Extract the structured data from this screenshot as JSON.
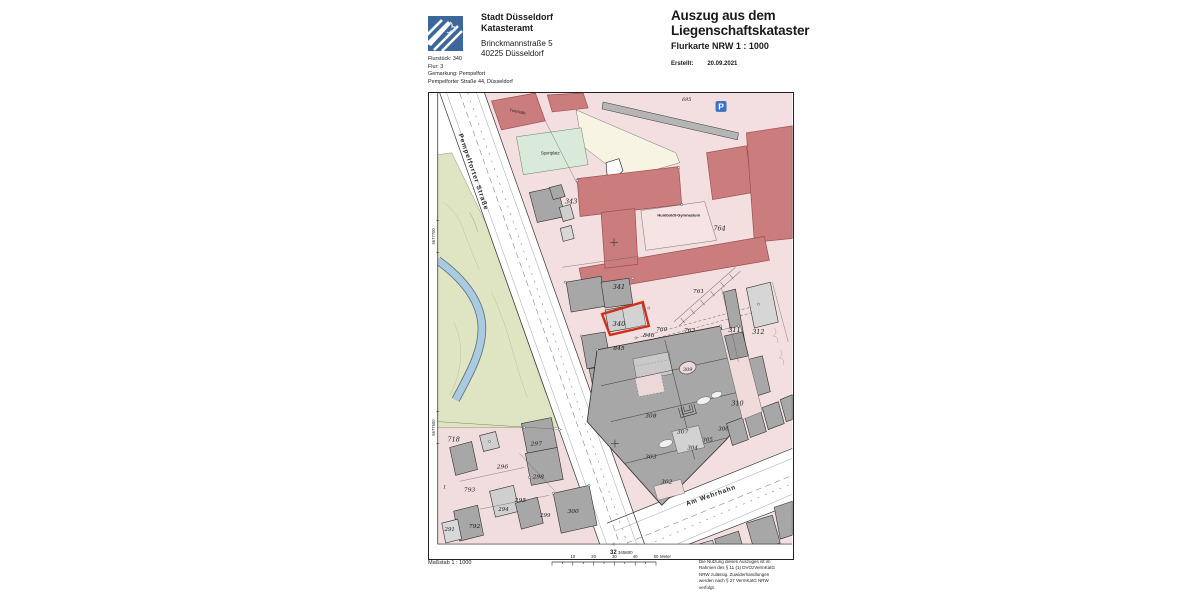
{
  "header": {
    "org_line1": "Stadt Düsseldorf",
    "org_line2": "Katasteramt",
    "address_line1": "Brinckmannstraße 5",
    "address_line2": "40225 Düsseldorf",
    "meta_lines": [
      "Flurstück: 340",
      "Flur: 3",
      "Gemarkung: Pempelfort",
      "Pempelforter Straße 44, Düsseldorf"
    ],
    "title_line1": "Auszug aus dem",
    "title_line2": "Liegenschaftskataster",
    "subtitle": "Flurkarte NRW 1 : 1000",
    "created_label": "Erstellt:",
    "created_date": "20.09.2021"
  },
  "map": {
    "highlight_parcel": "340",
    "parking_icon": "P",
    "colors": {
      "block_pink": "#f3dfdf",
      "building_gray": "#a7a7a7",
      "building_light": "#cfcfcf",
      "public_red": "#cb7d7d",
      "sport_green": "#d9e9da",
      "courtyard_cream": "#f8f4e4",
      "park_green": "#dfe5c2",
      "water_blue": "#a9cae1",
      "highlight_red": "#d22f1b"
    },
    "labels": [
      {
        "t": "695",
        "x": 258,
        "y": 8,
        "s": 5,
        "k": "num"
      },
      {
        "t": "343",
        "x": 142,
        "y": 111,
        "s": 6.5,
        "k": "num"
      },
      {
        "t": "341",
        "x": 190,
        "y": 197,
        "s": 6.5,
        "k": "num"
      },
      {
        "t": "340",
        "x": 190,
        "y": 234,
        "s": 6.8,
        "k": "num"
      },
      {
        "t": "764",
        "x": 291,
        "y": 138,
        "s": 6.5,
        "k": "num"
      },
      {
        "t": "761",
        "x": 270,
        "y": 201,
        "s": 6,
        "k": "num"
      },
      {
        "t": "760",
        "x": 233,
        "y": 239,
        "s": 6,
        "k": "num"
      },
      {
        "t": "846",
        "x": 220,
        "y": 245,
        "s": 6,
        "k": "num"
      },
      {
        "t": "763",
        "x": 261,
        "y": 240,
        "s": 6,
        "k": "num"
      },
      {
        "t": "845",
        "x": 190,
        "y": 258,
        "s": 6,
        "k": "num"
      },
      {
        "t": "311",
        "x": 306,
        "y": 240,
        "s": 6.5,
        "k": "num"
      },
      {
        "t": "312",
        "x": 330,
        "y": 242,
        "s": 6.5,
        "k": "num"
      },
      {
        "t": "309",
        "x": 259,
        "y": 279,
        "s": 5,
        "k": "num"
      },
      {
        "t": "310",
        "x": 309,
        "y": 314,
        "s": 6.5,
        "k": "num"
      },
      {
        "t": "308",
        "x": 222,
        "y": 326,
        "s": 6,
        "k": "num"
      },
      {
        "t": "307",
        "x": 254,
        "y": 342,
        "s": 6,
        "k": "num"
      },
      {
        "t": "306",
        "x": 295,
        "y": 339,
        "s": 5.5,
        "k": "num"
      },
      {
        "t": "305",
        "x": 279,
        "y": 350,
        "s": 5.5,
        "k": "num"
      },
      {
        "t": "304",
        "x": 264,
        "y": 358,
        "s": 5.5,
        "k": "num"
      },
      {
        "t": "303",
        "x": 222,
        "y": 367,
        "s": 6,
        "k": "num"
      },
      {
        "t": "302",
        "x": 238,
        "y": 392,
        "s": 6,
        "k": "num"
      },
      {
        "t": "718",
        "x": 24,
        "y": 350,
        "s": 6.5,
        "k": "num"
      },
      {
        "t": "297",
        "x": 107,
        "y": 354,
        "s": 6,
        "k": "num"
      },
      {
        "t": "296",
        "x": 73,
        "y": 377,
        "s": 6,
        "k": "num"
      },
      {
        "t": "298",
        "x": 109,
        "y": 387,
        "s": 6,
        "k": "num"
      },
      {
        "t": "793",
        "x": 40,
        "y": 400,
        "s": 6,
        "k": "num"
      },
      {
        "t": "295",
        "x": 91,
        "y": 411,
        "s": 6,
        "k": "num"
      },
      {
        "t": "294",
        "x": 74,
        "y": 420,
        "s": 5.5,
        "k": "num"
      },
      {
        "t": "299",
        "x": 116,
        "y": 426,
        "s": 5.5,
        "k": "num",
        "c": "#b03527"
      },
      {
        "t": "300",
        "x": 144,
        "y": 422,
        "s": 6,
        "k": "num"
      },
      {
        "t": "291",
        "x": 20,
        "y": 440,
        "s": 5.5,
        "k": "num"
      },
      {
        "t": "792",
        "x": 45,
        "y": 437,
        "s": 6,
        "k": "num"
      },
      {
        "t": "1",
        "x": 15,
        "y": 397,
        "s": 5,
        "k": "num"
      },
      {
        "t": "Turnhalle",
        "x": 88,
        "y": 20,
        "s": 4,
        "k": "name",
        "r": 12
      },
      {
        "t": "Sportplatz",
        "x": 121,
        "y": 62,
        "s": 4.2,
        "k": "name"
      },
      {
        "t": "Humboldt-Gymnasium",
        "x": 250,
        "y": 124,
        "s": 4,
        "k": "name",
        "w": "bold"
      },
      {
        "t": "Pempelforter Straße",
        "x": 42,
        "y": 80,
        "s": 6.5,
        "k": "name",
        "r": 71,
        "w": "bold",
        "ls": 1
      },
      {
        "t": "Am Wehrhahn",
        "x": 283,
        "y": 406,
        "s": 6.5,
        "k": "name",
        "r": -19,
        "w": "bold",
        "ls": 0.8
      },
      {
        "t": "5677700",
        "x": 5,
        "y": 144,
        "s": 4.2,
        "k": "name",
        "r": -90,
        "c": "#333"
      },
      {
        "t": "5677600",
        "x": 5,
        "y": 336,
        "s": 4.2,
        "k": "name",
        "r": -90,
        "c": "#333"
      },
      {
        "t": "32",
        "x": 181,
        "y": 463,
        "s": 6,
        "k": "coord",
        "a": "start",
        "w": "bold"
      },
      {
        "t": "345800",
        "x": 189,
        "y": 463,
        "s": 4.4,
        "k": "coord",
        "a": "start"
      }
    ]
  },
  "footer": {
    "scale_label": "Maßstab 1 : 1000",
    "scale_ticks": [
      "10",
      "20",
      "30",
      "40",
      "50"
    ],
    "scale_unit": "Meter",
    "legal_lines": [
      "Die Nutzung dieses Auszuges ist im",
      "Rahmen des § 11 (1) DVOzVermKatG",
      "NRW zulässig. Zuwiderhandlungen",
      "werden nach § 27 VermKatG NRW",
      "verfolgt."
    ]
  }
}
